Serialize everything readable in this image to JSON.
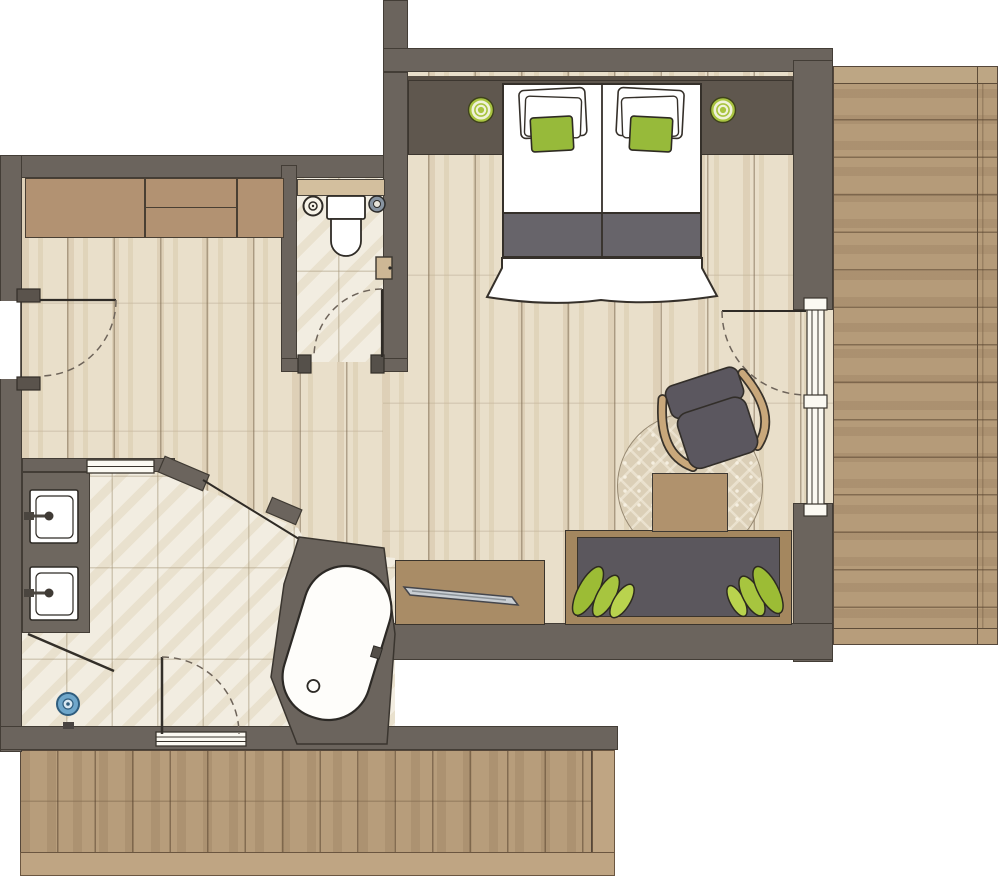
{
  "plan": {
    "type": "hotel-room-floor-plan",
    "rooms": [
      {
        "id": "bedroom",
        "label": "Bedroom and living area",
        "floor": "light wood planks"
      },
      {
        "id": "hallway",
        "label": "Entry hallway",
        "floor": "light wood planks"
      },
      {
        "id": "wc",
        "label": "Separate WC",
        "floor": "beige tiles"
      },
      {
        "id": "bathroom",
        "label": "Bathroom",
        "floor": "beige tiles"
      },
      {
        "id": "terrace",
        "label": "Side terrace",
        "floor": "wood decking, horizontal planks"
      },
      {
        "id": "deck",
        "label": "Lower deck",
        "floor": "wood decking, vertical planks"
      }
    ],
    "furniture": [
      {
        "id": "wardrobe",
        "label": "Built-in wardrobe"
      },
      {
        "id": "bed",
        "label": "Double bed with white pillows, green cushions and grey runner"
      },
      {
        "id": "lamp-left",
        "label": "Bedside lamp (green rings)"
      },
      {
        "id": "lamp-right",
        "label": "Bedside lamp (green rings)"
      },
      {
        "id": "toilet",
        "label": "Toilet with cistern"
      },
      {
        "id": "wc-cabinet",
        "label": "Wall cabinet"
      },
      {
        "id": "vanity",
        "label": "Vanity counter with two washbasins"
      },
      {
        "id": "shower",
        "label": "Walk-in shower with blue drain"
      },
      {
        "id": "bathtub",
        "label": "Freestanding angled bathtub"
      },
      {
        "id": "desk",
        "label": "Sideboard desk with flat-screen TV"
      },
      {
        "id": "sofa",
        "label": "Bench sofa with green cushions"
      },
      {
        "id": "armchair",
        "label": "Armchair with wooden arms"
      },
      {
        "id": "coffee-table",
        "label": "Coffee table"
      },
      {
        "id": "rug",
        "label": "Round patterned rug"
      }
    ],
    "openings": [
      {
        "id": "entrance-door",
        "label": "Entrance door with swing arc"
      },
      {
        "id": "wc-door",
        "label": "WC door with swing arc"
      },
      {
        "id": "bathroom-sliding-door",
        "label": "Bathroom sliding door"
      },
      {
        "id": "shower-door",
        "label": "Shower glass door with swing arc"
      },
      {
        "id": "terrace-glass-door",
        "label": "Glass door to terrace with swing arc"
      },
      {
        "id": "bathroom-window",
        "label": "Bathroom window"
      }
    ],
    "colors": {
      "wall": "#6b645d",
      "wall_outline": "#433d36",
      "wood_floor": "#e9dfca",
      "tile_floor": "#f2ede1",
      "decking": "#b59b79",
      "accent_green": "#9cbc3a",
      "furniture_wood": "#b29272",
      "dark_grey_upholstery": "#5b575d",
      "white": "#ffffff",
      "drain_blue": "#6fa7cb"
    }
  }
}
